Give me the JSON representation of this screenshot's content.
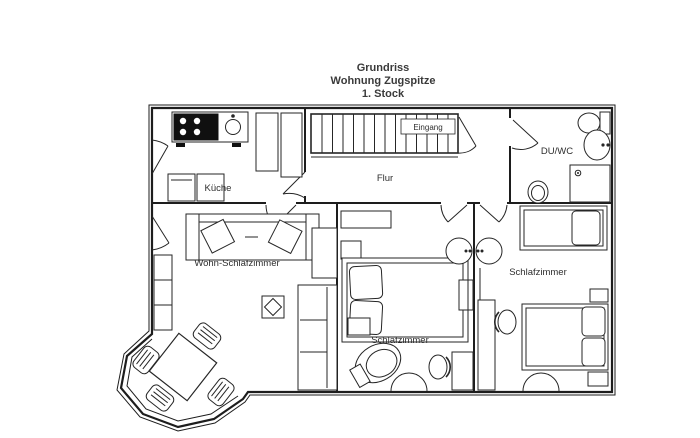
{
  "title": {
    "line1": "Grundriss",
    "line2": "Wohnung Zugspitze",
    "line3": "1. Stock"
  },
  "rooms": {
    "kueche": "Küche",
    "flur": "Flur",
    "eingang": "Eingang",
    "du_wc": "DU/WC",
    "wohn_schlafzimmer": "Wohn-Schlafzimmer",
    "schlafzimmer_mitte": "Schlafzimmer",
    "schlafzimmer_rechts": "Schlafzimmer"
  },
  "colors": {
    "line": "#1d1d1d",
    "background": "#ffffff",
    "text": "#2e2e2e"
  }
}
